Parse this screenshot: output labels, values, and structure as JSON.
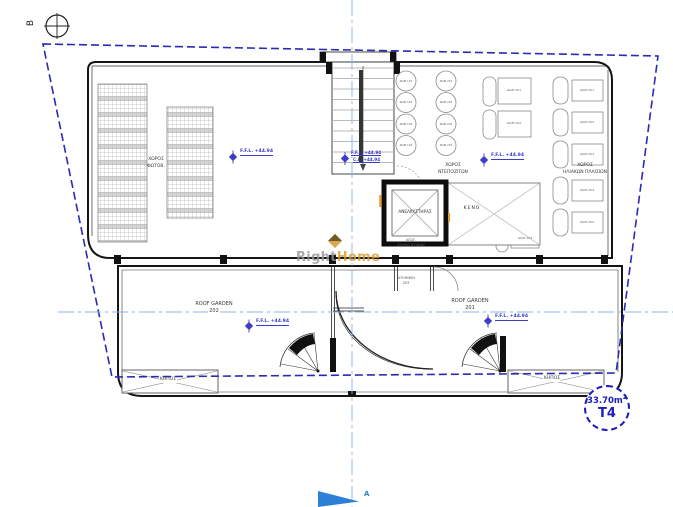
{
  "markers": {
    "section_b": "B",
    "section_a": "A"
  },
  "labels": {
    "pv_area": [
      "ΧΩΡΟΣ",
      "ΦΩΤΟΒ."
    ],
    "tanks_area": [
      "ΧΩΡΟΣ",
      "ΝΤΕΠΟΖΙΤΩΝ"
    ],
    "solar_area": [
      "ΧΩΡΟΣ",
      "ΗΛΙΑΚΩΝ ΠΛΑΙΣΙΩΝ"
    ],
    "elevator": "ΑΝΕΛΚΥΣΤΗΡΑΣ",
    "void": "ΚΕΝΟ",
    "ac_duct": [
      "ΑΓΩΓ.",
      "ΚΛΙΜΑΤΙΣΤΙΚΩΝ"
    ],
    "storage": [
      "ΑΠΟΘΗΚΗ",
      "203"
    ],
    "roof_garden_left": {
      "title": "ROOF GARDEN",
      "number": "202"
    },
    "roof_garden_right": {
      "title": "ROOF GARDEN",
      "number": "201"
    },
    "garden_left": "ΚΗΠΟΣ",
    "garden_right": "ΚΗΠΟΣ"
  },
  "levels": {
    "pv": "F.F.L. +44.94",
    "stair_ffl": "F.F.L. +44.94",
    "stair_cl": "C.L. +44.94",
    "tanks": "F.F.L. +44.94",
    "rg_left": "F.F.L. +44.94",
    "rg_right": "F.F.L. +44.94"
  },
  "tanks": {
    "col1": [
      "ΔΩΜ 101",
      "ΔΩΜ 102",
      "ΔΩΜ 103",
      "ΔΩΜ 104"
    ],
    "col2": [
      "ΔΩΜ 201",
      "ΔΩΜ 202",
      "ΔΩΜ 203",
      "ΔΩΜ 204"
    ]
  },
  "solar_mid": [
    "ΔΙΑΜ 101",
    "ΔΙΑΜ 102",
    "ΔΙΑΜ 103"
  ],
  "solar_right": [
    "ΔΙΑΜ 201",
    "ΔΙΑΜ 202",
    "ΔΙΑΜ 203",
    "ΔΙΑΜ 204",
    "ΔΙΑΜ 205"
  ],
  "watermark": {
    "part1": "Right",
    "part2": "Home"
  },
  "badge": {
    "area": "33.70m",
    "area_sup": "2",
    "unit": "T4"
  },
  "colors": {
    "boundary": "#2a2ab5",
    "centerline": "#85b4e8",
    "level_marker": "#3c3cc8",
    "badge": "#1c1cbe",
    "watermark_gray": "#97979c",
    "watermark_gold": "#d79a2e",
    "wall": "#151515",
    "section_arrow": "#2e7fd6",
    "door": "#e59a2a"
  }
}
